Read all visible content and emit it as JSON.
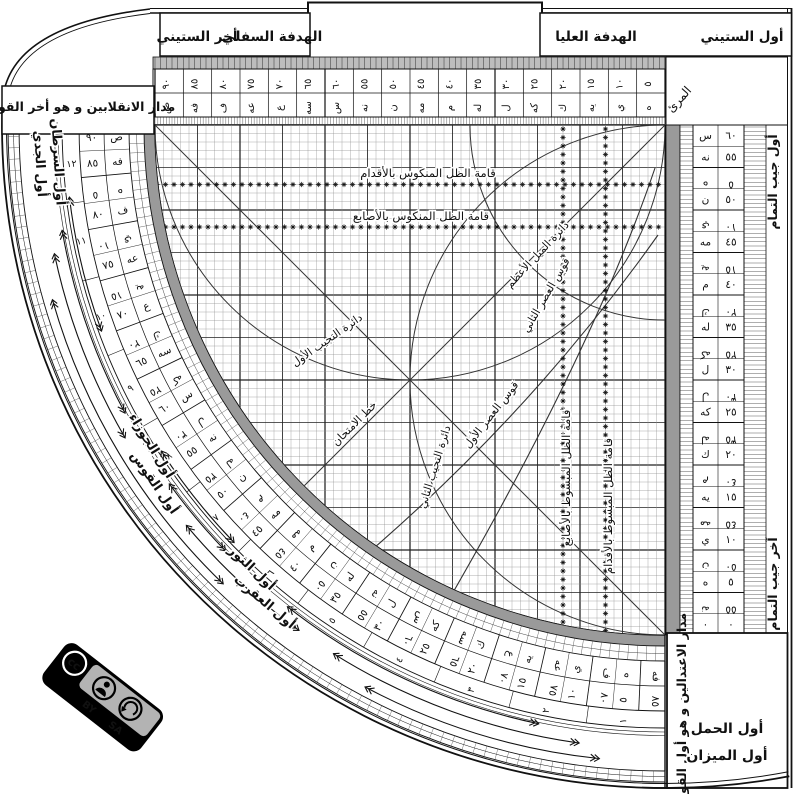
{
  "frame": {
    "top_left_box": "مدار الانقلابين و هو أخر القوس",
    "bottom_right_box": "مدار الاعتدالين و هو أول القوس",
    "muri": "المرئ",
    "cosine_start": "أول جيب التمام",
    "cosine_end": "آخر جيب التمام"
  },
  "headers": {
    "lower_sight": "الهدفة السفلي",
    "end_sixty": "أخر الستيني",
    "upper_sight": "الهدفة العليا",
    "start_sixty": "أول الستيني"
  },
  "grid_labels": {
    "mankus_feet": "قامة الظل المنكوس بالأقدام",
    "mankus_digits": "قامة الظل المنكوس بالأصابع",
    "mabsut_digits": "قامة الظل المبسوط بالأصابع",
    "mabsut_feet": "قامة الظل المبسوط بالأقدام",
    "mayl": "دائرة الميل الأعظم",
    "tajyib1": "دائرة التجيب الأول",
    "tajyib2": "دائرة التجيب الثاني",
    "asr1": "قوس العصر الأول",
    "asr2": "قوس العصر الثاني",
    "imtihan": "خط الامتحان"
  },
  "zodiac": {
    "cancer": "أول السرطان",
    "capricorn": "أول الجدي",
    "gemini": "أول الجوزاء",
    "sagittarius": "أول القوس",
    "taurus": "أول الثور",
    "scorpio": "أول العقرب",
    "aries": "أول الحمل",
    "libra": "أول الميزان"
  },
  "scales": {
    "degrees_main": [
      "٩٠",
      "٨٥",
      "٨٠",
      "٧٥",
      "٧٠",
      "٦٥",
      "٦٠",
      "٥٥",
      "٥٠",
      "٤٥",
      "٤٠",
      "٣٥",
      "٣٠",
      "٢٥",
      "٢٠",
      "١٥",
      "١٠",
      "٥"
    ],
    "degrees_main_abjad": [
      "ص",
      "فه",
      "ف",
      "عه",
      "ع",
      "سه",
      "س",
      "نه",
      "ن",
      "مه",
      "م",
      "له",
      "ل",
      "كه",
      "ك",
      "يه",
      "ي",
      "ه"
    ],
    "degrees_comp": [
      "٥",
      "١٠",
      "١٥",
      "٢٠",
      "٢٥",
      "٣٠",
      "٣٥",
      "٤٠",
      "٤٥",
      "٥٠",
      "٥٥",
      "٦٠",
      "٦٥",
      "٧٠",
      "٧٥",
      "٨٠",
      "٨٥"
    ],
    "degrees_comp_abjad": [
      "ه",
      "ي",
      "يه",
      "ك",
      "كه",
      "ل",
      "له",
      "م",
      "مه",
      "ن",
      "نه",
      "س",
      "سه",
      "ع",
      "عه",
      "ف",
      "فه"
    ],
    "months": [
      "١٢",
      "١١",
      "١٠",
      "٩",
      "٨",
      "٧",
      "٦",
      "٥",
      "٤",
      "٣",
      "٢",
      "١"
    ],
    "cosine_main": [
      "٦٠",
      "٥٥",
      "٥٠",
      "٤٥",
      "٤٠",
      "٣٥",
      "٣٠",
      "٢٥",
      "٢٠",
      "١٥",
      "١٠",
      "٥",
      "٠"
    ],
    "cosine_main_abjad": [
      "س",
      "نه",
      "ن",
      "مه",
      "م",
      "له",
      "ل",
      "كه",
      "ك",
      "يه",
      "ي",
      "ه",
      "٠"
    ],
    "cosine_comp": [
      "٥",
      "١٠",
      "١٥",
      "٢٠",
      "٢٥",
      "٣٠",
      "٣٥",
      "٤٠",
      "٤٥",
      "٥٠",
      "٥٥"
    ],
    "cosine_comp_abjad": [
      "ه",
      "ي",
      "يه",
      "ك",
      "كه",
      "ل",
      "له",
      "م",
      "مه",
      "ن",
      "نه"
    ]
  },
  "license": {
    "cc": "cc",
    "by": "BY",
    "sa": "SA"
  },
  "colors": {
    "ink": "#111111",
    "band": "#9a9a9a",
    "badge_gray": "#b3b3b3"
  }
}
